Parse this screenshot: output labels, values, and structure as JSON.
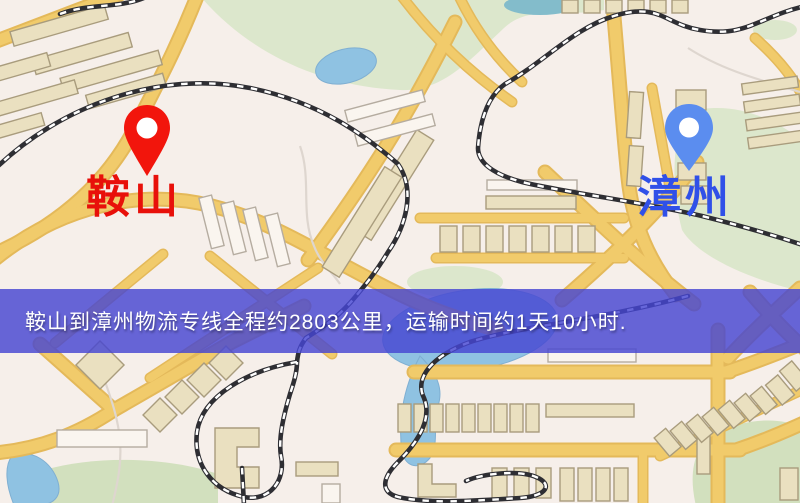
{
  "map_view": {
    "type": "logistics-route-map",
    "origin_marker": {
      "label": "鞍山",
      "icon": "map-pin-icon",
      "pin_style": "red-solid"
    },
    "destination_marker": {
      "label": "漳州",
      "icon": "map-pin-icon",
      "pin_style": "blue-solid"
    },
    "banner": {
      "text": "鞍山到漳州物流专线全程约2803公里，运输时间约1天10小时."
    }
  },
  "colors": {
    "map_bg": "#F6EFEA",
    "road": "#F1CB6B",
    "road_edge": "#E4B95A",
    "water": "#8FC2E2",
    "pond_teal": "#83BCCB",
    "park": "#DCE7CC",
    "building": "#EAE0C0",
    "building_outline": "#A99C7D",
    "building_white": "#FAF5EF",
    "railway": "#2E2E33",
    "banner_bg": "rgba(70,70,210,0.82)",
    "banner_text": "#FFFFFF",
    "origin_text": "#E8100A",
    "origin_pin": "#F2150C",
    "destination_text": "#3050E8",
    "destination_pin": "#5B8DEF"
  }
}
